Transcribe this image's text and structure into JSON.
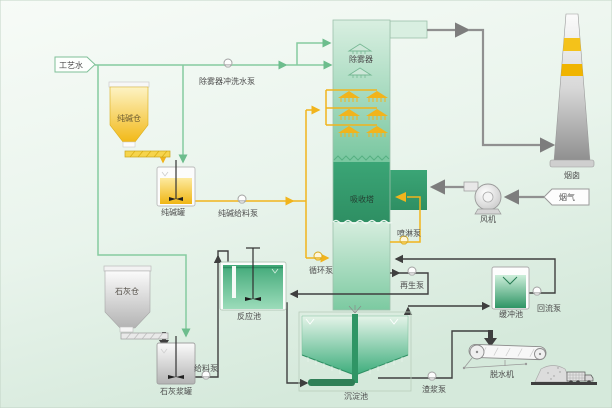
{
  "diagram": {
    "type": "flue-gas-desulfurization-process-flow",
    "labels": {
      "process_water": "工艺水",
      "demister_flush_pump": "除雾器冲洗水泵",
      "soda_silo": "纯碱仓",
      "soda_tank": "纯碱罐",
      "soda_feed_pump": "纯碱给料泵",
      "demister": "除雾器",
      "absorber": "吸收塔",
      "spray_pump": "喷淋泵",
      "circulation_pump": "循环泵",
      "regen_pump": "再生泵",
      "chimney": "烟囱",
      "flue_gas": "烟气",
      "fan": "风机",
      "lime_silo": "石灰仓",
      "lime_slurry_tank": "石灰浆罐",
      "lime_feed_pump": "给料泵",
      "reaction_pool": "反应池",
      "sedimentation_pool": "沉淀池",
      "slag_pump": "渣浆泵",
      "buffer_pool": "缓冲池",
      "return_pump": "回流泵",
      "dewatering_machine": "脱水机"
    },
    "colors": {
      "water_line_green": "#85cba0",
      "reagent_line_yellow": "#f1b41c",
      "gas_line_gray": "#909090",
      "sludge_line_dark": "#3f3f3f",
      "tower_green": "#35a06f",
      "silo_yellow": "#f3c01c",
      "chimney_band_yellow": "#f0b400",
      "background_green": "#dcEEe1"
    }
  }
}
